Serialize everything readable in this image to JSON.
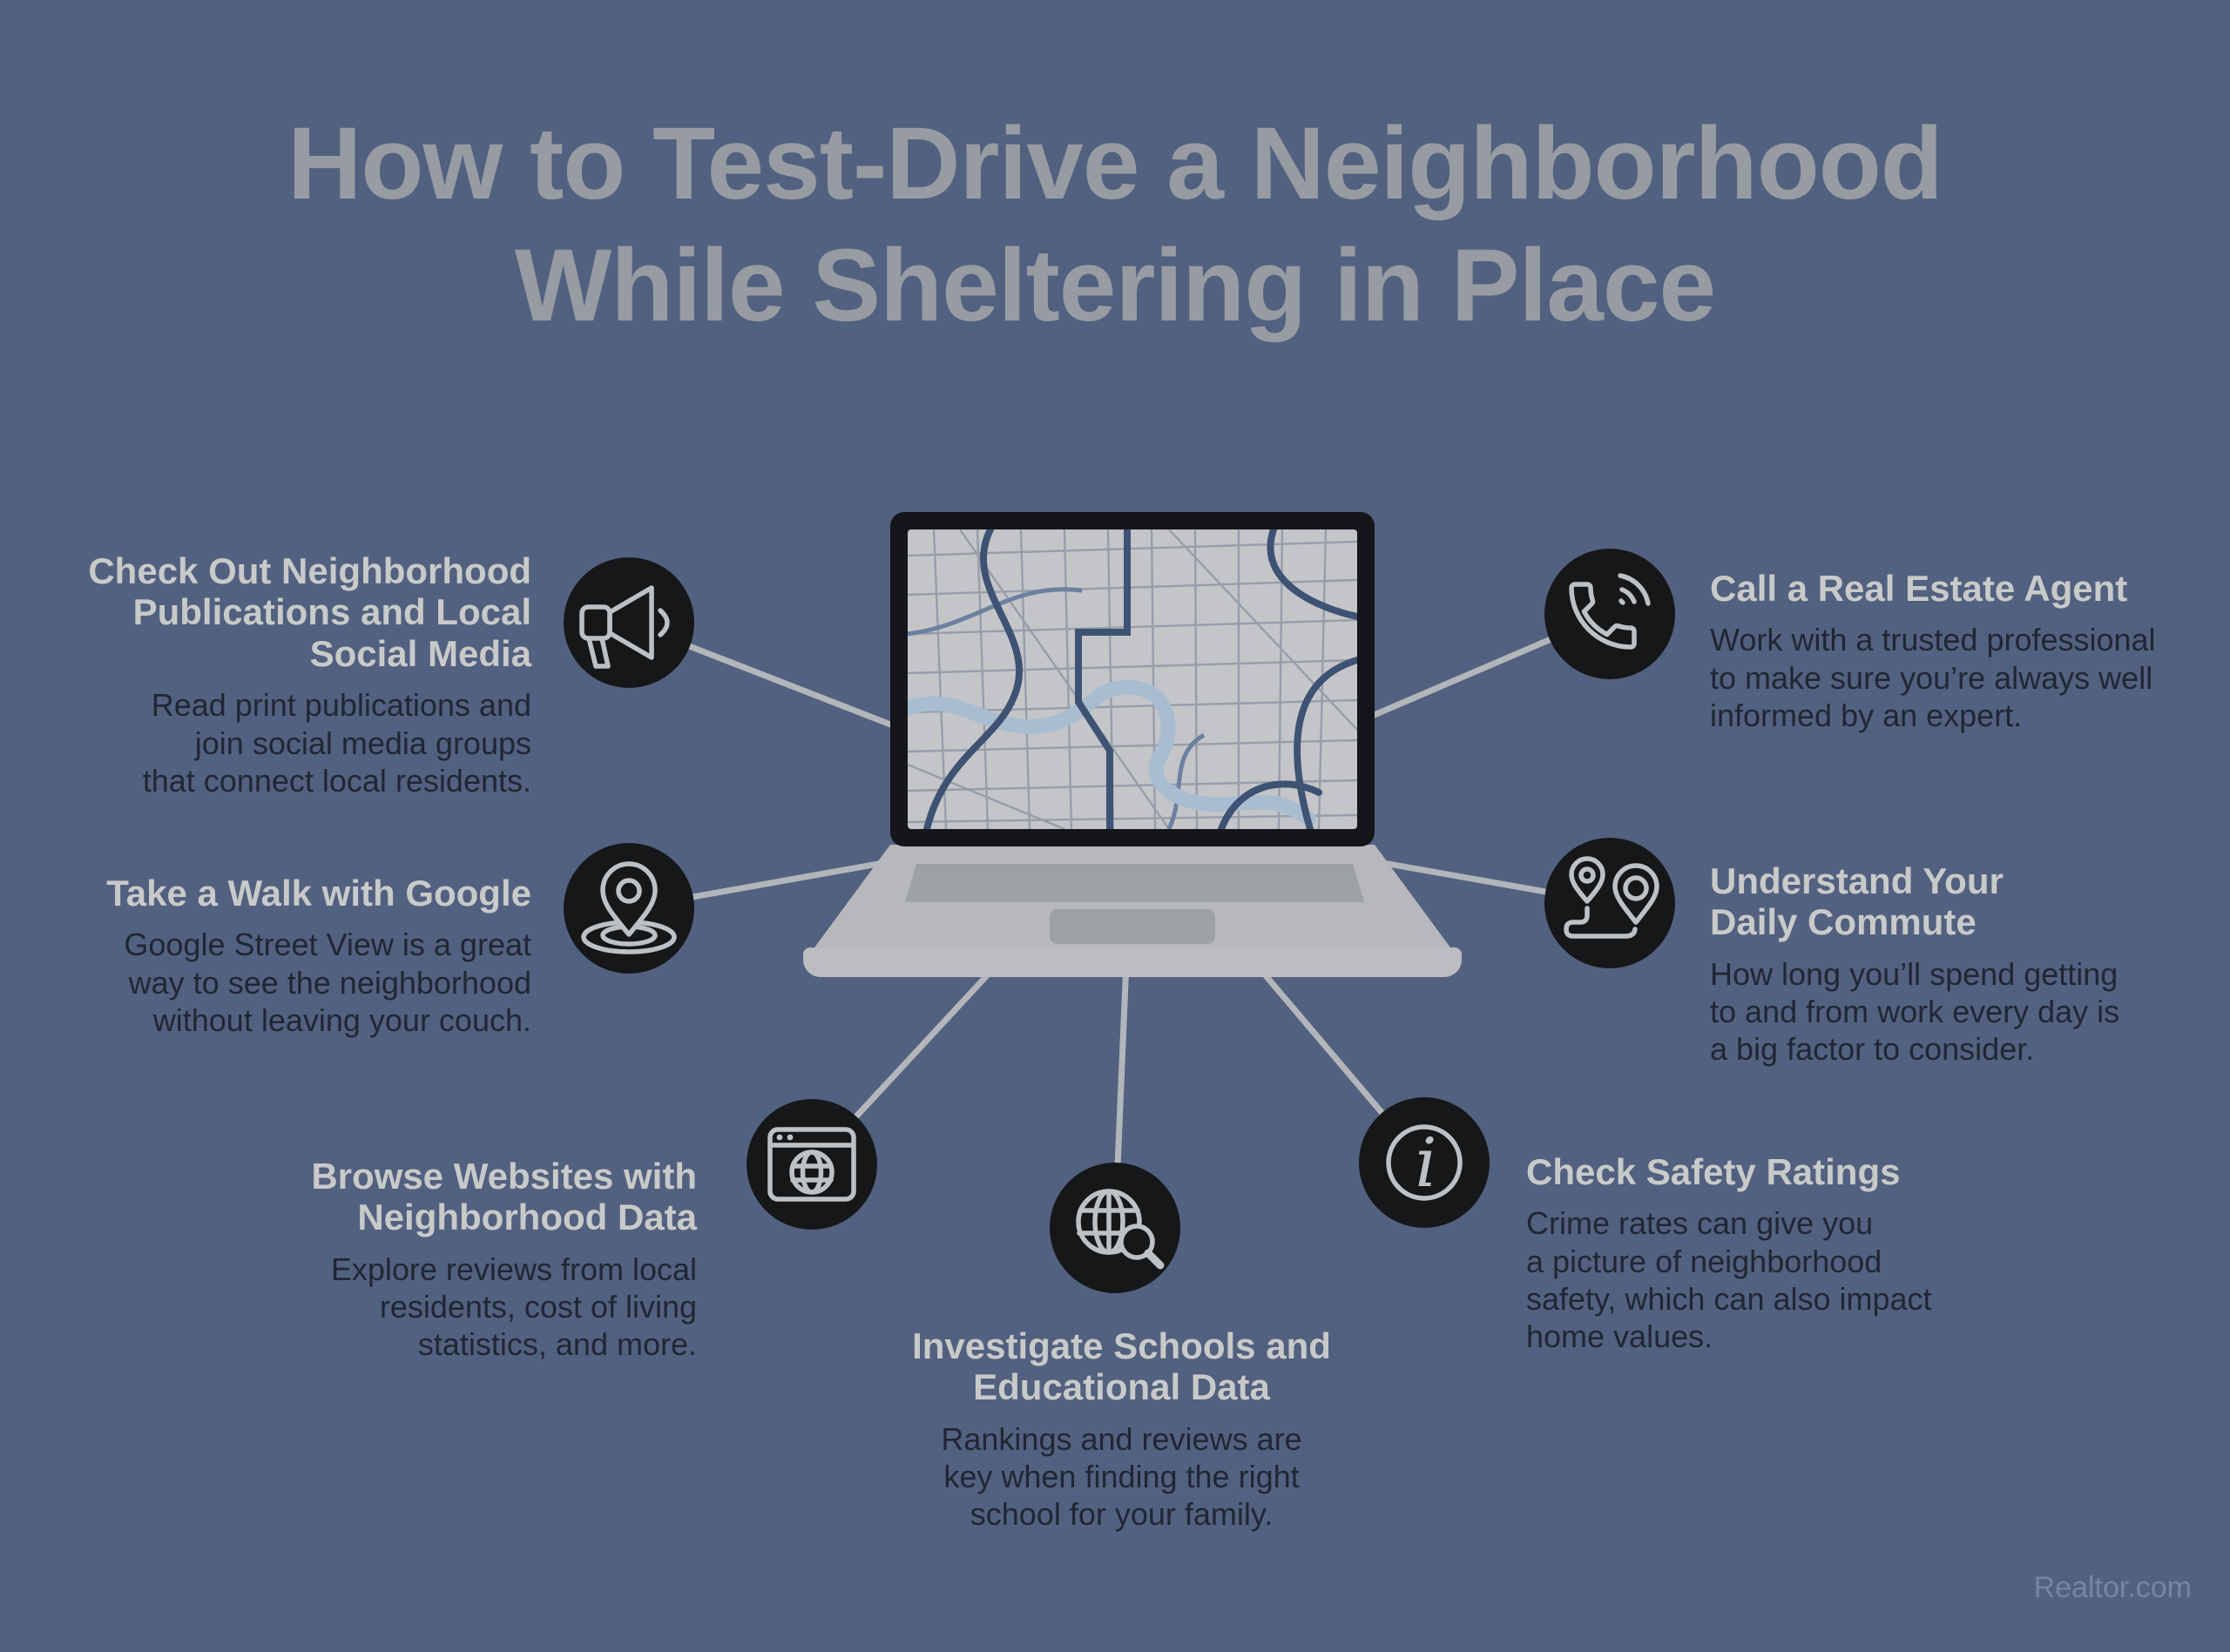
{
  "title": "How to Test-Drive a Neighborhood\nWhile Sheltering in Place",
  "watermark": "Realtor.com",
  "colors": {
    "background": "#536180",
    "title_text": "#969CA2",
    "heading_text": "#C8CAC9",
    "body_text": "#1F2734",
    "icon_circle": "#161719",
    "icon_stroke": "#BEC1C3",
    "connector_line": "#B2B6BA",
    "laptop_body": "#B7B8BB",
    "map_road_major": "#3E5273",
    "map_river": "#A9BDD1"
  },
  "center_graphic": "laptop-with-street-map",
  "items": [
    {
      "icon": "megaphone-icon",
      "heading": "Check Out Neighborhood\nPublications and Local\nSocial Media",
      "body": "Read print publications and\njoin social media groups\nthat connect local residents."
    },
    {
      "icon": "map-pin-icon",
      "heading": "Take a Walk with Google",
      "body": "Google Street View is a great\nway to see the neighborhood\nwithout leaving your couch."
    },
    {
      "icon": "browser-globe-icon",
      "heading": "Browse Websites with\nNeighborhood Data",
      "body": "Explore reviews from local\nresidents, cost of living\nstatistics, and more."
    },
    {
      "icon": "globe-search-icon",
      "heading": "Investigate Schools and\nEducational Data",
      "body": "Rankings and reviews are\nkey when finding the right\nschool for your family."
    },
    {
      "icon": "info-icon",
      "heading": "Check Safety Ratings",
      "body": "Crime rates can give you\na picture of neighborhood\nsafety, which can also impact\nhome values."
    },
    {
      "icon": "route-pins-icon",
      "heading": "Understand Your\nDaily Commute",
      "body": "How long you’ll spend getting\nto and from work every day is\na big factor to consider."
    },
    {
      "icon": "phone-icon",
      "heading": "Call a Real Estate Agent",
      "body": "Work with a trusted professional\nto make sure you’re always well\ninformed by an expert."
    }
  ]
}
